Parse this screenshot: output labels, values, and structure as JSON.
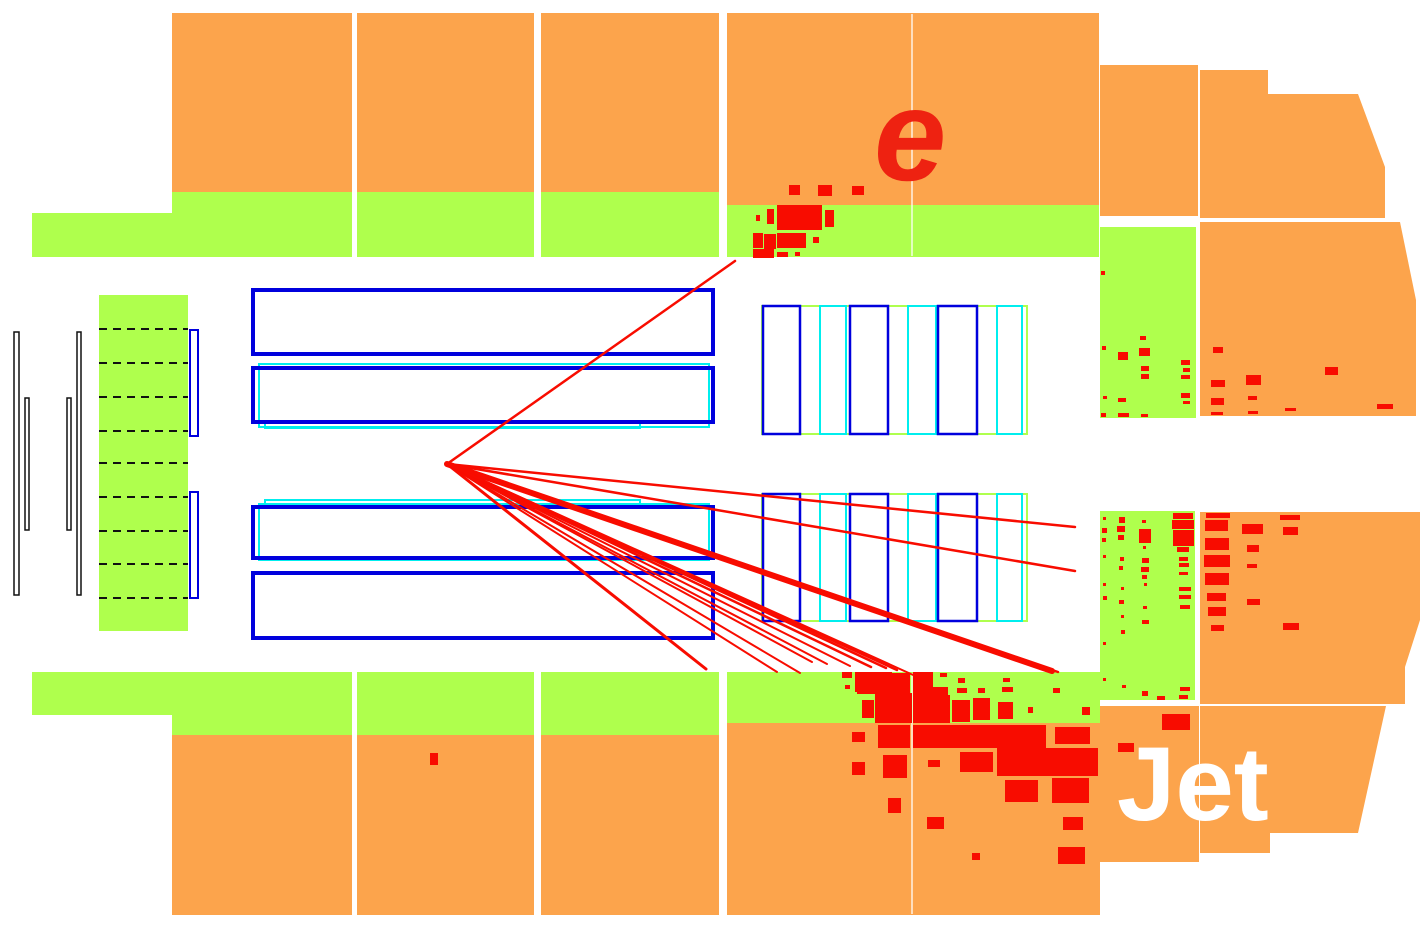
{
  "labels": {
    "electron": {
      "text": "e",
      "x": 874,
      "y": 180,
      "size": 130,
      "color": "#EE2211",
      "style": "italic",
      "weight": "bold"
    },
    "jet": {
      "text": "Jet",
      "x": 1117,
      "y": 820,
      "size": 105,
      "color": "#FFFFFF",
      "style": "normal",
      "weight": "bold"
    }
  },
  "colors": {
    "background": "#FFFFFF",
    "hadronic_calo": "#FCA44C",
    "em_calo": "#AFFF4D",
    "deposit_red": "#F80C00",
    "track_red": "#F80C00",
    "tracker_blue": "#0000DD",
    "tracker_cyan": "#00EEEE",
    "outline_black": "#111111",
    "cell_divider": "rgba(255,255,255,0.85)"
  },
  "calorimeter": {
    "hadronic_cells": [
      [
        172,
        13,
        180,
        179
      ],
      [
        357,
        13,
        177,
        179
      ],
      [
        541,
        13,
        178,
        179
      ],
      [
        727,
        13,
        372,
        192
      ],
      [
        1100,
        65,
        98,
        151
      ],
      [
        172,
        735,
        180,
        180
      ],
      [
        357,
        735,
        177,
        180
      ],
      [
        541,
        735,
        178,
        180
      ],
      [
        727,
        723,
        373,
        192
      ],
      [
        1100,
        706,
        99,
        156
      ]
    ],
    "hadronic_polys": [
      "1200,70 1268,70 1268,94 1358,94 1385,167 1385,218 1200,218",
      "1200,222 1400,222 1416,300 1416,416 1200,416",
      "1200,512 1420,512 1420,620 1405,667 1405,704 1200,704",
      "1200,706 1386,706 1358,833 1270,833 1270,853 1200,853"
    ],
    "em_cells": [
      [
        32,
        213,
        140,
        44
      ],
      [
        172,
        192,
        180,
        65
      ],
      [
        357,
        192,
        177,
        65
      ],
      [
        541,
        192,
        178,
        65
      ],
      [
        727,
        205,
        372,
        52
      ],
      [
        1100,
        227,
        96,
        191
      ],
      [
        1100,
        511,
        95,
        189
      ],
      [
        32,
        672,
        140,
        43
      ],
      [
        172,
        672,
        180,
        63
      ],
      [
        357,
        672,
        177,
        63
      ],
      [
        541,
        672,
        178,
        63
      ],
      [
        727,
        672,
        373,
        51
      ],
      [
        99,
        295,
        89,
        336
      ]
    ],
    "cell_dividers": [
      [
        912,
        14,
        912,
        256
      ],
      [
        912,
        673,
        912,
        914
      ]
    ]
  },
  "tracker": {
    "central_blue_rects": [
      [
        253,
        290,
        460,
        64
      ],
      [
        253,
        368,
        460,
        54
      ],
      [
        253,
        507,
        460,
        51
      ],
      [
        253,
        573,
        460,
        65
      ]
    ],
    "central_cyan_rects": [
      [
        259,
        364,
        450,
        63
      ],
      [
        265,
        421,
        375,
        7
      ],
      [
        265,
        500,
        375,
        7
      ],
      [
        259,
        504,
        450,
        56
      ]
    ],
    "left_black_rects": [
      [
        14,
        332,
        5,
        263
      ],
      [
        25,
        398,
        4,
        132
      ],
      [
        67,
        398,
        4,
        132
      ],
      [
        77,
        332,
        4,
        263
      ]
    ],
    "left_blue_rects": [
      [
        190,
        330,
        8,
        106
      ],
      [
        190,
        492,
        8,
        106
      ]
    ],
    "dashed_lines": {
      "x1": 99,
      "x2": 188,
      "ys": [
        329,
        363,
        397,
        431,
        463,
        497,
        531,
        564,
        598
      ]
    },
    "forward_green_rects": [
      [
        762,
        306,
        265,
        128
      ],
      [
        762,
        494,
        265,
        127
      ]
    ],
    "forward_blue_rects": [
      [
        763,
        306,
        37,
        128
      ],
      [
        850,
        306,
        38,
        128
      ],
      [
        938,
        306,
        39,
        128
      ],
      [
        763,
        494,
        37,
        127
      ],
      [
        850,
        494,
        38,
        127
      ],
      [
        938,
        494,
        39,
        127
      ]
    ],
    "forward_cyan_rects": [
      [
        820,
        306,
        26,
        128
      ],
      [
        908,
        306,
        28,
        128
      ],
      [
        997,
        306,
        25,
        128
      ],
      [
        820,
        494,
        26,
        127
      ],
      [
        908,
        494,
        28,
        127
      ],
      [
        997,
        494,
        25,
        127
      ]
    ]
  },
  "event": {
    "vertex": {
      "x": 447,
      "y": 464
    },
    "electron_track": {
      "x2": 735,
      "y2": 261,
      "width": 2.5
    },
    "tracks": [
      {
        "x2": 1075,
        "y2": 527,
        "width": 2.5
      },
      {
        "x2": 1075,
        "y2": 571,
        "width": 2.5
      },
      {
        "x2": 1052,
        "y2": 671,
        "width": 6
      },
      {
        "x2": 706,
        "y2": 669,
        "width": 3
      },
      {
        "x2": 777,
        "y2": 672,
        "width": 2
      },
      {
        "x2": 800,
        "y2": 673,
        "width": 2
      },
      {
        "x2": 812,
        "y2": 662,
        "width": 2
      },
      {
        "x2": 827,
        "y2": 664,
        "width": 2
      },
      {
        "x2": 850,
        "y2": 666,
        "width": 2
      },
      {
        "x2": 871,
        "y2": 667,
        "width": 2.5
      },
      {
        "x2": 886,
        "y2": 668,
        "width": 2.5
      },
      {
        "x2": 897,
        "y2": 670,
        "width": 2.5
      },
      {
        "x2": 922,
        "y2": 679,
        "width": 2
      },
      {
        "x2": 1058,
        "y2": 672,
        "width": 2.5
      }
    ],
    "deposits": [
      [
        789,
        185,
        11,
        10
      ],
      [
        818,
        185,
        14,
        11
      ],
      [
        852,
        186,
        12,
        9
      ],
      [
        777,
        205,
        45,
        25
      ],
      [
        825,
        210,
        9,
        17
      ],
      [
        767,
        209,
        7,
        15
      ],
      [
        756,
        215,
        4,
        6
      ],
      [
        753,
        233,
        10,
        15
      ],
      [
        764,
        234,
        12,
        15
      ],
      [
        777,
        233,
        29,
        15
      ],
      [
        813,
        237,
        6,
        6
      ],
      [
        753,
        249,
        21,
        9
      ],
      [
        777,
        252,
        11,
        5
      ],
      [
        795,
        252,
        5,
        4
      ],
      [
        842,
        672,
        10,
        6
      ],
      [
        855,
        672,
        37,
        20
      ],
      [
        892,
        673,
        18,
        9
      ],
      [
        913,
        672,
        20,
        25
      ],
      [
        940,
        673,
        7,
        4
      ],
      [
        958,
        678,
        7,
        5
      ],
      [
        1003,
        678,
        7,
        4
      ],
      [
        1053,
        688,
        7,
        5
      ],
      [
        845,
        685,
        5,
        4
      ],
      [
        857,
        680,
        53,
        14
      ],
      [
        933,
        687,
        15,
        10
      ],
      [
        957,
        688,
        10,
        5
      ],
      [
        978,
        688,
        7,
        5
      ],
      [
        1002,
        687,
        11,
        5
      ],
      [
        862,
        700,
        12,
        18
      ],
      [
        875,
        693,
        37,
        30
      ],
      [
        913,
        695,
        37,
        28
      ],
      [
        952,
        700,
        18,
        22
      ],
      [
        973,
        698,
        17,
        22
      ],
      [
        998,
        702,
        15,
        17
      ],
      [
        1028,
        707,
        5,
        6
      ],
      [
        1082,
        707,
        8,
        8
      ],
      [
        852,
        732,
        13,
        10
      ],
      [
        878,
        725,
        32,
        23
      ],
      [
        913,
        725,
        133,
        23
      ],
      [
        1055,
        727,
        35,
        17
      ],
      [
        852,
        762,
        13,
        13
      ],
      [
        883,
        755,
        24,
        23
      ],
      [
        928,
        760,
        12,
        7
      ],
      [
        960,
        752,
        33,
        20
      ],
      [
        997,
        748,
        101,
        28
      ],
      [
        1005,
        780,
        33,
        22
      ],
      [
        1052,
        778,
        37,
        25
      ],
      [
        888,
        798,
        13,
        15
      ],
      [
        927,
        817,
        17,
        12
      ],
      [
        1063,
        817,
        20,
        13
      ],
      [
        972,
        853,
        8,
        7
      ],
      [
        1058,
        847,
        27,
        17
      ],
      [
        430,
        753,
        8,
        12
      ],
      [
        1101,
        271,
        4,
        4
      ],
      [
        1102,
        346,
        4,
        4
      ],
      [
        1118,
        352,
        10,
        8
      ],
      [
        1140,
        336,
        6,
        4
      ],
      [
        1139,
        348,
        11,
        8
      ],
      [
        1141,
        366,
        8,
        5
      ],
      [
        1141,
        374,
        8,
        5
      ],
      [
        1181,
        360,
        9,
        5
      ],
      [
        1183,
        368,
        7,
        4
      ],
      [
        1181,
        375,
        9,
        4
      ],
      [
        1103,
        396,
        4,
        3
      ],
      [
        1118,
        398,
        8,
        4
      ],
      [
        1181,
        393,
        9,
        5
      ],
      [
        1183,
        401,
        7,
        3
      ],
      [
        1101,
        413,
        5,
        4
      ],
      [
        1118,
        413,
        11,
        4
      ],
      [
        1141,
        414,
        7,
        3
      ],
      [
        1213,
        347,
        10,
        6
      ],
      [
        1211,
        380,
        14,
        7
      ],
      [
        1246,
        375,
        15,
        10
      ],
      [
        1325,
        367,
        13,
        8
      ],
      [
        1211,
        398,
        13,
        7
      ],
      [
        1248,
        396,
        9,
        4
      ],
      [
        1377,
        404,
        16,
        5
      ],
      [
        1211,
        412,
        12,
        3
      ],
      [
        1248,
        411,
        10,
        3
      ],
      [
        1285,
        408,
        11,
        3
      ],
      [
        1103,
        517,
        3,
        3
      ],
      [
        1102,
        528,
        5,
        5
      ],
      [
        1102,
        538,
        4,
        4
      ],
      [
        1103,
        555,
        3,
        3
      ],
      [
        1103,
        583,
        3,
        3
      ],
      [
        1103,
        596,
        4,
        4
      ],
      [
        1103,
        642,
        3,
        3
      ],
      [
        1103,
        678,
        3,
        3
      ],
      [
        1119,
        517,
        6,
        6
      ],
      [
        1117,
        526,
        8,
        6
      ],
      [
        1118,
        535,
        6,
        5
      ],
      [
        1120,
        557,
        4,
        4
      ],
      [
        1119,
        566,
        4,
        4
      ],
      [
        1121,
        587,
        3,
        3
      ],
      [
        1119,
        600,
        5,
        4
      ],
      [
        1121,
        615,
        3,
        3
      ],
      [
        1121,
        630,
        4,
        4
      ],
      [
        1122,
        685,
        4,
        3
      ],
      [
        1142,
        520,
        4,
        3
      ],
      [
        1139,
        529,
        12,
        14
      ],
      [
        1143,
        546,
        3,
        3
      ],
      [
        1142,
        558,
        7,
        5
      ],
      [
        1141,
        567,
        8,
        5
      ],
      [
        1142,
        575,
        5,
        4
      ],
      [
        1144,
        583,
        3,
        3
      ],
      [
        1143,
        606,
        4,
        3
      ],
      [
        1142,
        620,
        7,
        4
      ],
      [
        1142,
        691,
        6,
        5
      ],
      [
        1157,
        696,
        8,
        4
      ],
      [
        1173,
        513,
        20,
        6
      ],
      [
        1172,
        520,
        22,
        9
      ],
      [
        1173,
        530,
        21,
        16
      ],
      [
        1177,
        547,
        12,
        5
      ],
      [
        1179,
        557,
        9,
        4
      ],
      [
        1179,
        563,
        10,
        4
      ],
      [
        1179,
        572,
        9,
        3
      ],
      [
        1179,
        587,
        12,
        4
      ],
      [
        1179,
        595,
        12,
        4
      ],
      [
        1180,
        605,
        10,
        4
      ],
      [
        1180,
        687,
        10,
        4
      ],
      [
        1179,
        695,
        9,
        4
      ],
      [
        1206,
        513,
        24,
        5
      ],
      [
        1205,
        520,
        23,
        11
      ],
      [
        1205,
        538,
        24,
        12
      ],
      [
        1204,
        555,
        26,
        12
      ],
      [
        1205,
        573,
        24,
        12
      ],
      [
        1207,
        593,
        19,
        8
      ],
      [
        1208,
        607,
        18,
        9
      ],
      [
        1211,
        625,
        13,
        6
      ],
      [
        1242,
        524,
        21,
        10
      ],
      [
        1247,
        545,
        12,
        7
      ],
      [
        1247,
        564,
        10,
        4
      ],
      [
        1247,
        599,
        13,
        6
      ],
      [
        1280,
        515,
        20,
        5
      ],
      [
        1283,
        527,
        15,
        8
      ],
      [
        1283,
        623,
        16,
        7
      ],
      [
        1162,
        714,
        28,
        16
      ],
      [
        1118,
        743,
        16,
        9
      ]
    ]
  }
}
